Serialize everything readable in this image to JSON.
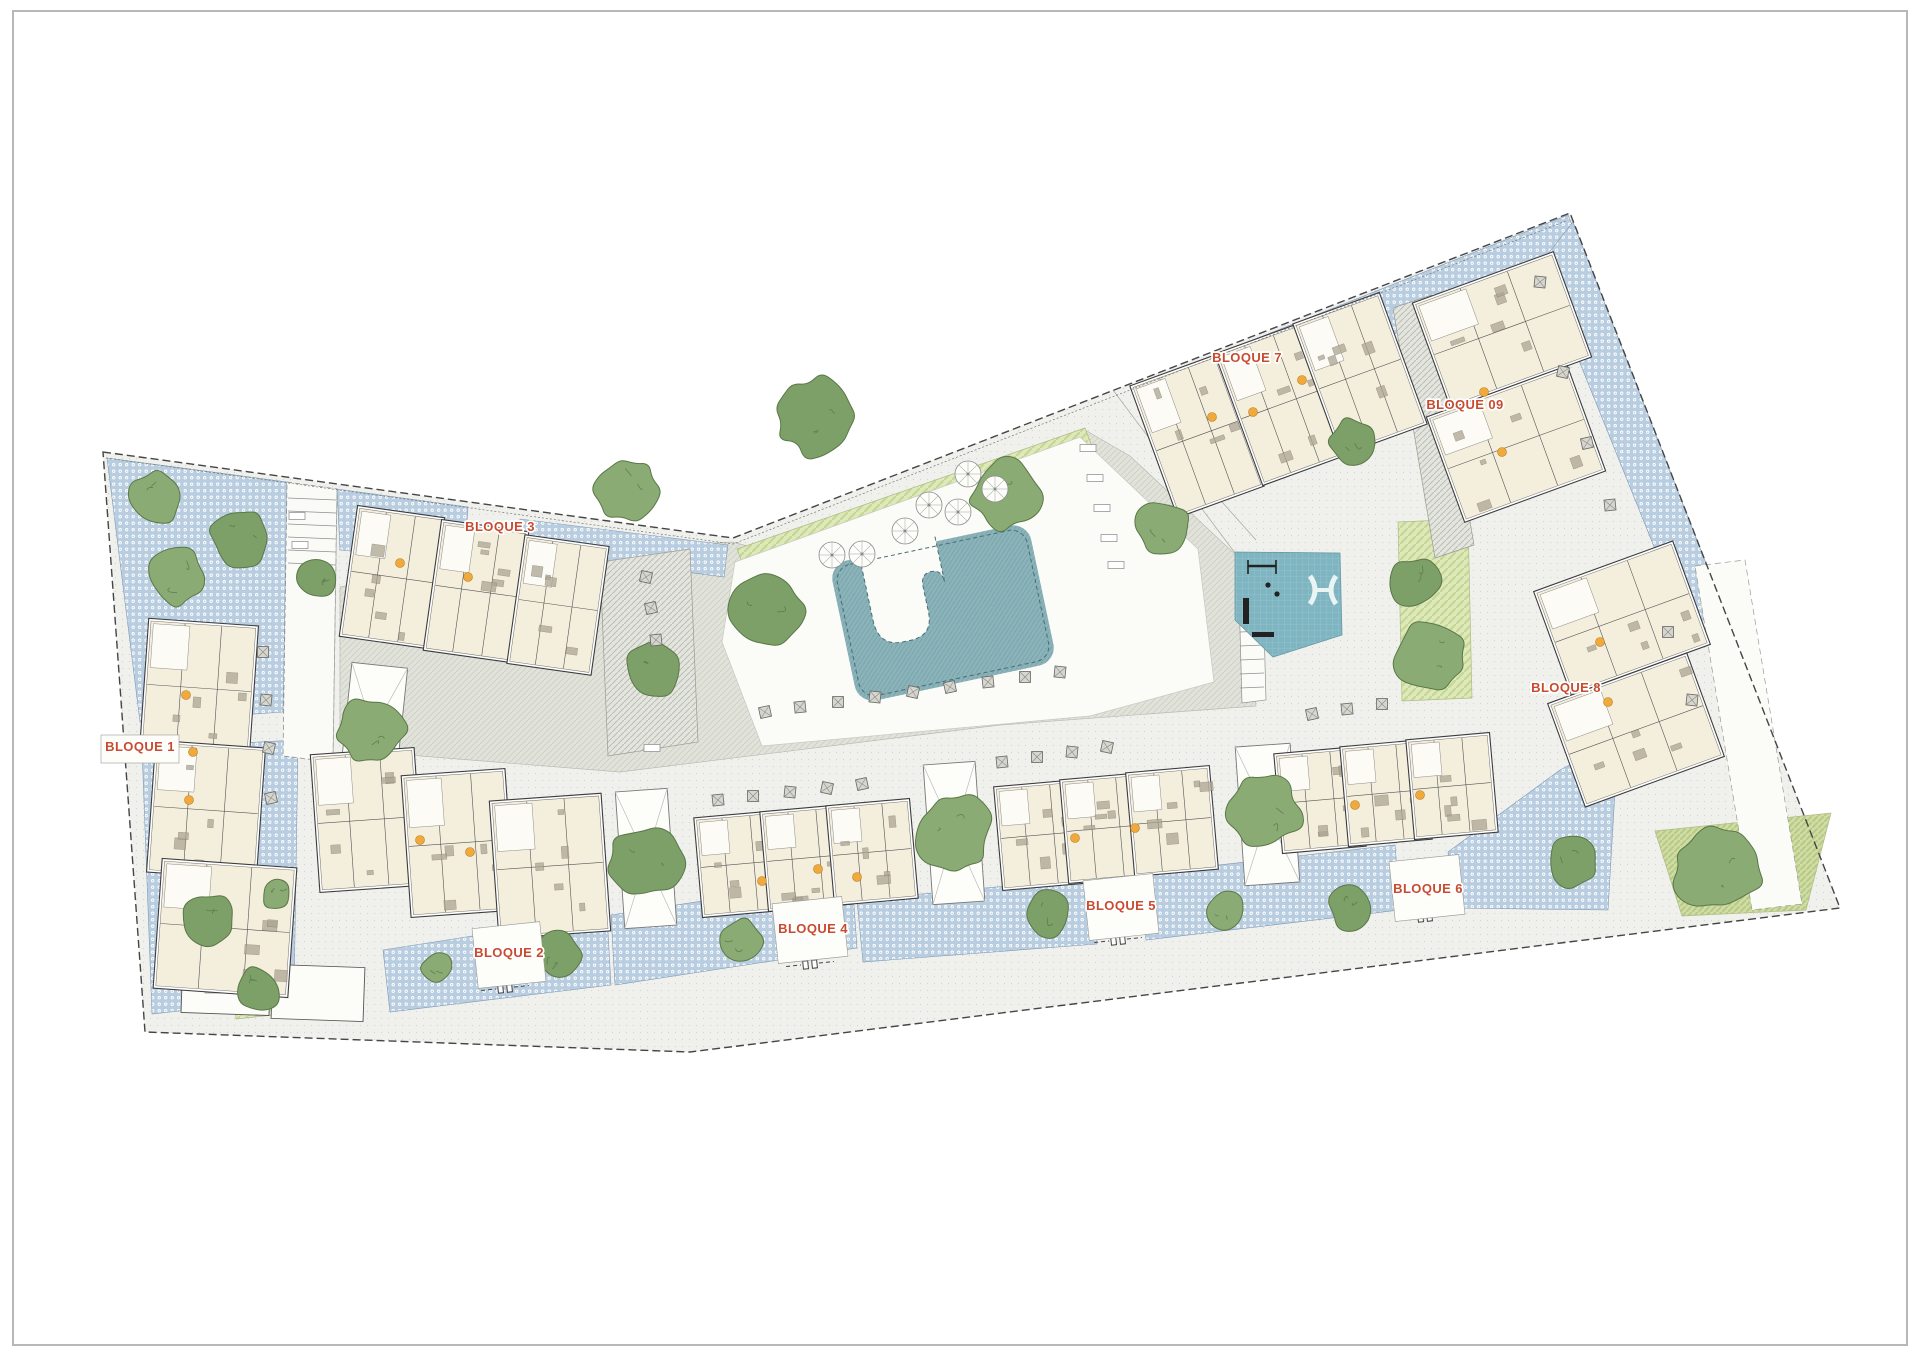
{
  "page": {
    "background": "#ffffff",
    "frame_color": "#b8b8b8"
  },
  "plan": {
    "type": "residential-site-plan",
    "blocks": [
      {
        "id": "bloque-1",
        "label": "BLOQUE 1"
      },
      {
        "id": "bloque-2",
        "label": "BLOQUE 2"
      },
      {
        "id": "bloque-3",
        "label": "BLOQUE 3"
      },
      {
        "id": "bloque-4",
        "label": "BLOQUE 4"
      },
      {
        "id": "bloque-5",
        "label": "BLOQUE 5"
      },
      {
        "id": "bloque-6",
        "label": "BLOQUE 6"
      },
      {
        "id": "bloque-7",
        "label": "BLOQUE 7"
      },
      {
        "id": "bloque-8",
        "label": "BLOQUE 8"
      },
      {
        "id": "bloque-9",
        "label": "BLOQUE 09"
      }
    ],
    "label_color": "#c84b2f",
    "colors": {
      "paving": "#f0f1ed",
      "paving_dot": "#d3d6d1",
      "plaza_gray": "#e1e3db",
      "plaza_hatch": "#c8cbc0",
      "patio_blue": "#b9cde0",
      "patio_dot": "#ffffff",
      "pool_teal": "#8ab3ba",
      "pool_hatch": "#79a2aa",
      "deck_white": "#fbfbf8",
      "playground_teal": "#7fb5c1",
      "playground_grid": "#a3cdd6",
      "lawn_green": "#dde8bb",
      "lawn_stripe": "#c6d693",
      "lawn2_green": "#cfdda4",
      "lawn2_stripe": "#b7c985",
      "tree_green_a": "#7d9f68",
      "tree_green_b": "#8aab74",
      "tree_edge": "#5b7748",
      "building_fill": "#f4eedd",
      "building_wall": "#3c3c3c",
      "entry_marker_orange": "#efa93c",
      "boundary": "#454545"
    }
  }
}
